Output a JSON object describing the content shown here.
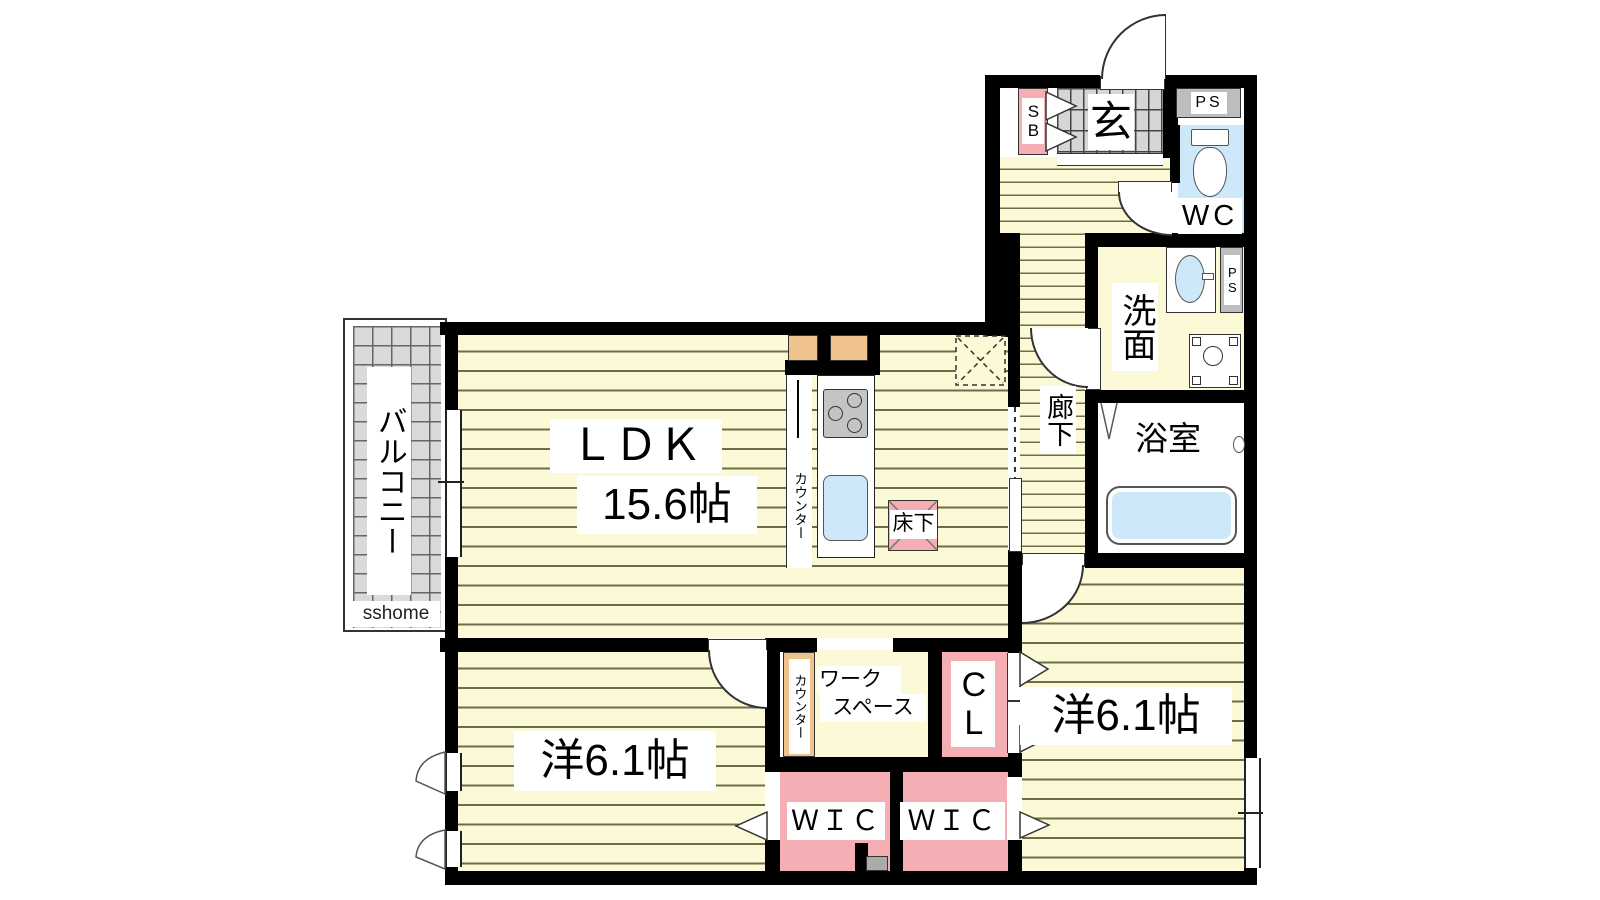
{
  "watermark": "sshome",
  "rooms": {
    "balcony": {
      "name": "バルコニー"
    },
    "ldk": {
      "name": "ＬＤＫ",
      "size": "15.6帖"
    },
    "kitchen_counter": {
      "name": "カウンター"
    },
    "underfloor_storage": {
      "name": "床下"
    },
    "entrance": {
      "name": "玄"
    },
    "shoe_box": {
      "name": "SB"
    },
    "pipe_space_top": {
      "name": "PS"
    },
    "pipe_space_side": {
      "name": "PS"
    },
    "toilet": {
      "name": "WC"
    },
    "washroom": {
      "name": "洗面"
    },
    "corridor": {
      "name": "廊下"
    },
    "bathroom": {
      "name": "浴室"
    },
    "bedroom_left": {
      "name": "洋6.1帖"
    },
    "bedroom_right": {
      "name": "洋6.1帖"
    },
    "workspace": {
      "name_line1": "ワーク",
      "name_line2": "スペース"
    },
    "workspace_counter": {
      "name": "カウンター"
    },
    "closet": {
      "name": "CL"
    },
    "wic_left": {
      "name": "ＷＩＣ"
    },
    "wic_right": {
      "name": "ＷＩＣ"
    }
  },
  "colors": {
    "floor_yellow": "#FCF9D6",
    "stripe_line": "#6E6D49",
    "accent_pink": "#F5AEB4",
    "accent_tan": "#F0C28C",
    "water_blue": "#CDE8F8",
    "tile_gray": "#D8D8D8",
    "ps_gray": "#BDBDBD",
    "wall_black": "#000000"
  }
}
